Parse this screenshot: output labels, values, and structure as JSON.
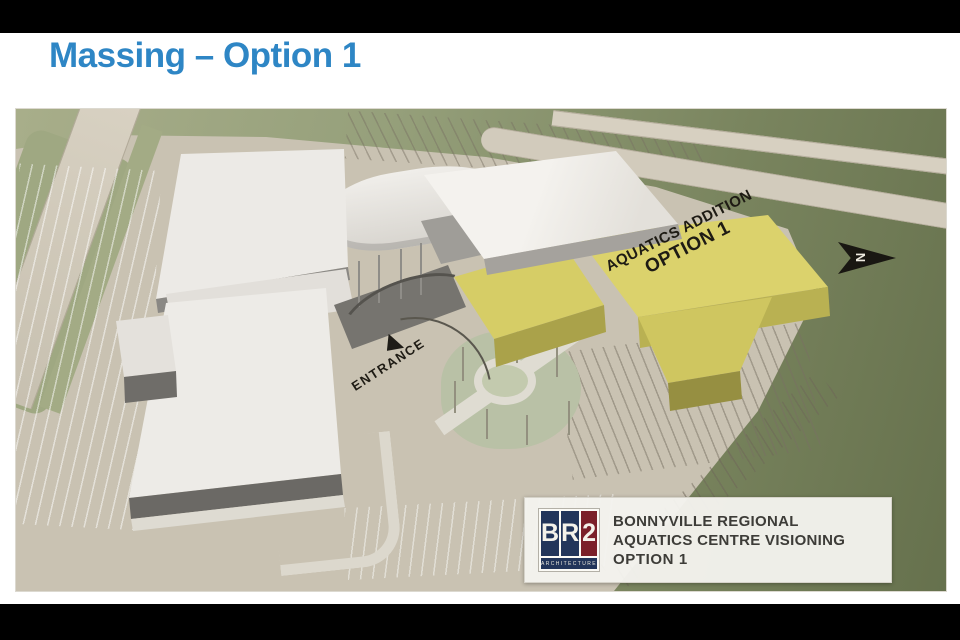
{
  "slide": {
    "title": "Massing – Option 1"
  },
  "scene": {
    "addition_label": {
      "line1": "AQUATICS ADDITION",
      "line2": "OPTION 1"
    },
    "entrance_label": "ENTRANCE",
    "north_label": "N"
  },
  "title_block": {
    "logo": {
      "letters": [
        "B",
        "R",
        "2"
      ],
      "subtitle": "ARCHITECTURE"
    },
    "lines": [
      "BONNYVILLE REGIONAL",
      "AQUATICS CENTRE VISIONING",
      "OPTION 1"
    ]
  },
  "colors": {
    "title_blue": "#2E86C5",
    "addition_yellow": "#D8CF68",
    "grass_green": "#8A9470",
    "pavement_beige": "#C9C2B2",
    "logo_navy": "#22355A",
    "logo_red": "#7B2029",
    "letterbox_black": "#000000"
  }
}
